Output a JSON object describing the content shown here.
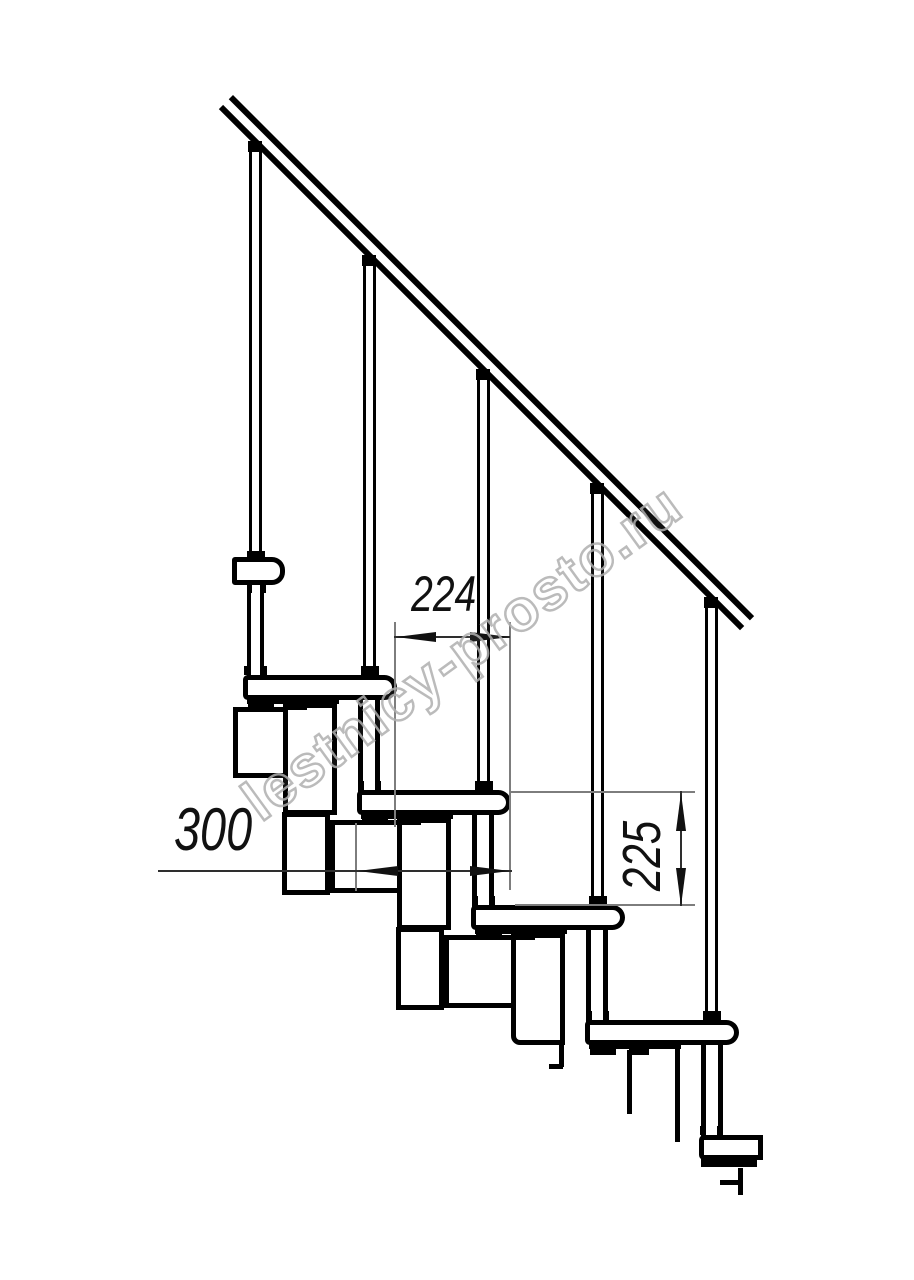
{
  "page": {
    "width": 914,
    "height": 1280,
    "background": "#ffffff"
  },
  "watermark": {
    "text": "lestnicy-prosto.ru",
    "color": "#b0b0b0",
    "angle_deg": -36
  },
  "dimensions": {
    "step_run": {
      "value": "224",
      "orientation": "horizontal"
    },
    "tread_depth": {
      "value": "300",
      "orientation": "horizontal"
    },
    "step_rise": {
      "value": "225",
      "orientation": "vertical"
    }
  },
  "drawing": {
    "line_color": "#000000",
    "extension_line_color": "#7d7d7d",
    "dimension_line_color": "#2e2e2e",
    "shapes": [
      [
        "box",
        233,
        707,
        57,
        71,
        "module-box"
      ],
      [
        "box",
        283,
        703,
        54,
        112,
        "module-box"
      ],
      [
        "box",
        282,
        812,
        48,
        83,
        "module-box"
      ],
      [
        "box",
        330,
        820,
        73,
        73,
        "module-box"
      ],
      [
        "box",
        397,
        818,
        54,
        112,
        "module-box"
      ],
      [
        "box",
        396,
        927,
        48,
        83,
        "module-box"
      ],
      [
        "box",
        444,
        935,
        73,
        73,
        "module-box"
      ],
      [
        "box boxr",
        511,
        933,
        54,
        112,
        "module-box"
      ],
      [
        "fill",
        559,
        1045,
        5,
        22,
        "module-cut-line"
      ],
      [
        "fill",
        549,
        1064,
        14,
        5,
        "module-cut-line"
      ],
      [
        "fill",
        627,
        1050,
        5,
        64,
        "module-cut-line"
      ],
      [
        "fill",
        675,
        1043,
        5,
        99,
        "module-cut-line"
      ],
      [
        "fill",
        738,
        1168,
        5,
        15,
        "module-cut-line"
      ],
      [
        "fill",
        720,
        1180,
        23,
        5,
        "module-cut-line"
      ],
      [
        "fill",
        738,
        1183,
        5,
        12,
        "module-cut-line"
      ],
      [
        "balu",
        249,
        150,
        13,
        410,
        "baluster"
      ],
      [
        "balu",
        363,
        264,
        13,
        413,
        "baluster"
      ],
      [
        "balu",
        477,
        378,
        13,
        414,
        "baluster"
      ],
      [
        "balu",
        591,
        492,
        13,
        415,
        "baluster"
      ],
      [
        "balu",
        705,
        606,
        13,
        416,
        "baluster"
      ],
      [
        "tube tube0",
        247,
        583,
        17,
        94,
        "baluster-lower-tube"
      ],
      [
        "tube",
        358,
        700,
        22,
        92,
        "baluster-lower-tube"
      ],
      [
        "tube",
        472,
        815,
        22,
        92,
        "baluster-lower-tube"
      ],
      [
        "tube",
        586,
        930,
        22,
        92,
        "baluster-lower-tube"
      ],
      [
        "tube",
        701,
        1045,
        22,
        92,
        "baluster-lower-tube"
      ],
      [
        "tread treadA",
        232,
        557,
        53,
        28,
        "tread"
      ],
      [
        "tread",
        243,
        675,
        154,
        25,
        "tread"
      ],
      [
        "tread",
        357,
        790,
        154,
        25,
        "tread"
      ],
      [
        "tread",
        471,
        905,
        154,
        25,
        "tread"
      ],
      [
        "tread",
        585,
        1020,
        154,
        25,
        "tread"
      ],
      [
        "tread treadF",
        699,
        1135,
        64,
        25,
        "tread"
      ],
      [
        "fill",
        247,
        697,
        92,
        7,
        "tread-underside"
      ],
      [
        "fill",
        361,
        812,
        92,
        7,
        "tread-underside"
      ],
      [
        "fill",
        475,
        927,
        92,
        7,
        "tread-underside"
      ],
      [
        "fill",
        589,
        1042,
        92,
        7,
        "tread-underside"
      ],
      [
        "fill",
        701,
        1158,
        56,
        9,
        "tread-underside"
      ],
      [
        "fill",
        248,
        704,
        26,
        6,
        "tread-mount"
      ],
      [
        "fill",
        287,
        704,
        20,
        6,
        "tread-mount"
      ],
      [
        "fill",
        362,
        819,
        26,
        6,
        "tread-mount"
      ],
      [
        "fill",
        401,
        819,
        20,
        6,
        "tread-mount"
      ],
      [
        "fill",
        476,
        934,
        26,
        6,
        "tread-mount"
      ],
      [
        "fill",
        515,
        934,
        20,
        6,
        "tread-mount"
      ],
      [
        "fill",
        590,
        1049,
        26,
        6,
        "tread-mount"
      ],
      [
        "fill",
        629,
        1049,
        20,
        6,
        "tread-mount"
      ],
      [
        "fill",
        247,
        551,
        18,
        9,
        "baluster-collar"
      ],
      [
        "fill",
        361,
        666,
        18,
        9,
        "baluster-collar"
      ],
      [
        "fill",
        475,
        781,
        18,
        9,
        "baluster-collar"
      ],
      [
        "fill",
        589,
        896,
        18,
        9,
        "baluster-collar"
      ],
      [
        "fill",
        703,
        1011,
        18,
        9,
        "baluster-collar"
      ],
      [
        "fill",
        244,
        666,
        6,
        9,
        "baluster-foot"
      ],
      [
        "fill",
        261,
        666,
        6,
        9,
        "baluster-foot"
      ],
      [
        "fill",
        358,
        781,
        6,
        9,
        "baluster-foot"
      ],
      [
        "fill",
        375,
        781,
        6,
        9,
        "baluster-foot"
      ],
      [
        "fill",
        472,
        896,
        6,
        9,
        "baluster-foot"
      ],
      [
        "fill",
        489,
        896,
        6,
        9,
        "baluster-foot"
      ],
      [
        "fill",
        586,
        1011,
        6,
        9,
        "baluster-foot"
      ],
      [
        "fill",
        603,
        1011,
        6,
        9,
        "baluster-foot"
      ],
      [
        "fill",
        700,
        1126,
        6,
        9,
        "baluster-foot"
      ],
      [
        "fill",
        717,
        1126,
        6,
        9,
        "baluster-foot"
      ],
      [
        "fill",
        247,
        585,
        5,
        8,
        "baluster-foot"
      ],
      [
        "fill",
        261,
        585,
        5,
        8,
        "baluster-foot"
      ],
      [
        "fill",
        248,
        141,
        14,
        11,
        "baluster-cap"
      ],
      [
        "fill",
        362,
        255,
        14,
        11,
        "baluster-cap"
      ],
      [
        "fill",
        476,
        369,
        14,
        11,
        "baluster-cap"
      ],
      [
        "fill",
        590,
        483,
        14,
        11,
        "baluster-cap"
      ],
      [
        "fill",
        704,
        597,
        14,
        11,
        "baluster-cap"
      ],
      [
        "ext",
        394,
        622,
        2,
        205,
        "extension-line"
      ],
      [
        "ext",
        509,
        622,
        2,
        268,
        "extension-line"
      ],
      [
        "ext",
        355,
        823,
        2,
        68,
        "extension-line"
      ],
      [
        "ext",
        509,
        791,
        186,
        2,
        "extension-line"
      ],
      [
        "ext",
        515,
        904,
        180,
        2,
        "extension-line"
      ],
      [
        "dim",
        394,
        636,
        116,
        2,
        "dimension-line"
      ],
      [
        "dim",
        158,
        870,
        354,
        2,
        "dimension-line"
      ],
      [
        "dim",
        680,
        791,
        2,
        115,
        "dimension-line"
      ]
    ]
  }
}
